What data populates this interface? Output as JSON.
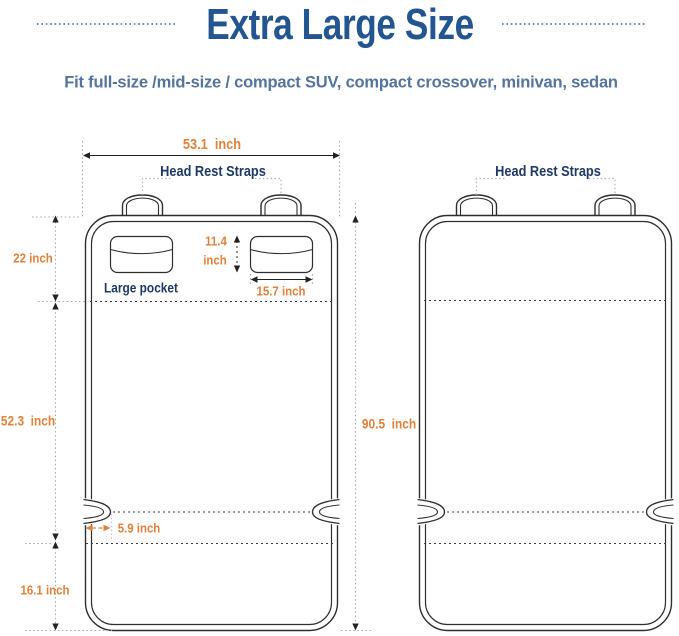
{
  "header": {
    "title": "Extra Large Size",
    "subtitle": "Fit full-size /mid-size / compact SUV, compact crossover, minivan, sedan"
  },
  "left_diagram": {
    "width_label": "53.1  inch",
    "headrest_label": "Head Rest Straps",
    "backrest_height_label": "22 inch",
    "pocket_height_value": "11.4",
    "pocket_height_unit": "inch",
    "pocket_name": "Large pocket",
    "pocket_width_label": "15.7 inch",
    "seat_length_label": "52.3  inch",
    "notch_depth_label": "5.9 inch",
    "front_flap_label": "16.1 inch"
  },
  "right_diagram": {
    "headrest_label": "Head Rest Straps",
    "total_length_label": "90.5  inch"
  },
  "colors": {
    "title_blue": "#235590",
    "subtitle_blue": "#54749e",
    "label_navy": "#1d3a66",
    "dimension_orange": "#e0813c",
    "outline_dark": "#2e2e2e"
  }
}
